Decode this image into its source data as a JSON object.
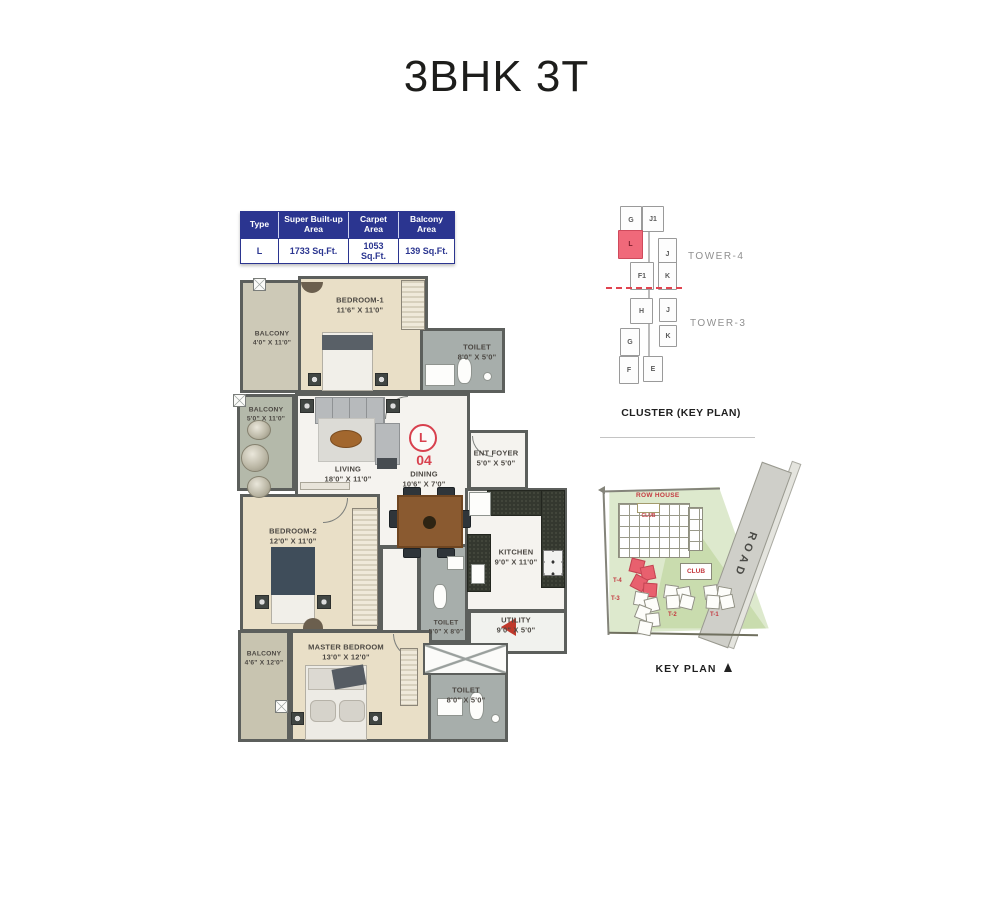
{
  "title": "3BHK 3T",
  "area_table": {
    "headers": [
      "Type",
      "Super Built-up Area",
      "Carpet Area",
      "Balcony Area"
    ],
    "row": [
      "L",
      "1733 Sq.Ft.",
      "1053 Sq.Ft.",
      "139 Sq.Ft."
    ],
    "header_bg": "#2b3590"
  },
  "floor_plan": {
    "unit_letter": "L",
    "unit_number": "04",
    "accent_red": "#d8404e",
    "rooms": [
      {
        "name": "BALCONY",
        "dims": "4'0\" X 11'0\""
      },
      {
        "name": "BEDROOM-1",
        "dims": "11'6\" X 11'0\""
      },
      {
        "name": "TOILET",
        "dims": "8'0\" X 5'0\""
      },
      {
        "name": "BALCONY",
        "dims": "5'0\" X 11'0\""
      },
      {
        "name": "LIVING",
        "dims": "18'0\" X 11'0\""
      },
      {
        "name": "DINING",
        "dims": "10'6\" X 7'0\""
      },
      {
        "name": "ENT FOYER",
        "dims": "5'0\" X 5'0\""
      },
      {
        "name": "KITCHEN",
        "dims": "9'0\" X 11'0\""
      },
      {
        "name": "BEDROOM-2",
        "dims": "12'0\" X 11'0\""
      },
      {
        "name": "TOILET",
        "dims": "5'0\" X 8'0\""
      },
      {
        "name": "UTILITY",
        "dims": "9'0\" X 5'0\""
      },
      {
        "name": "MASTER BEDROOM",
        "dims": "13'0\" X 12'0\""
      },
      {
        "name": "BALCONY",
        "dims": "4'6\" X 12'0\""
      },
      {
        "name": "TOILET",
        "dims": "8'0\" X 5'0\""
      }
    ]
  },
  "cluster_plan": {
    "caption": "CLUSTER (KEY PLAN)",
    "tower_labels": [
      "TOWER-4",
      "TOWER-3"
    ],
    "units": [
      "G",
      "J1",
      "L",
      "J",
      "F1",
      "K",
      "H",
      "J",
      "G",
      "K",
      "F",
      "E"
    ],
    "highlighted_unit": "L",
    "highlight_color": "#f0697a"
  },
  "key_plan": {
    "caption": "KEY PLAN",
    "row_house": "ROW HOUSE",
    "club": "CLUB",
    "club_small": "CLUB",
    "road": "ROAD",
    "towers": [
      "T-4",
      "T-3",
      "T-2",
      "T-1"
    ]
  }
}
